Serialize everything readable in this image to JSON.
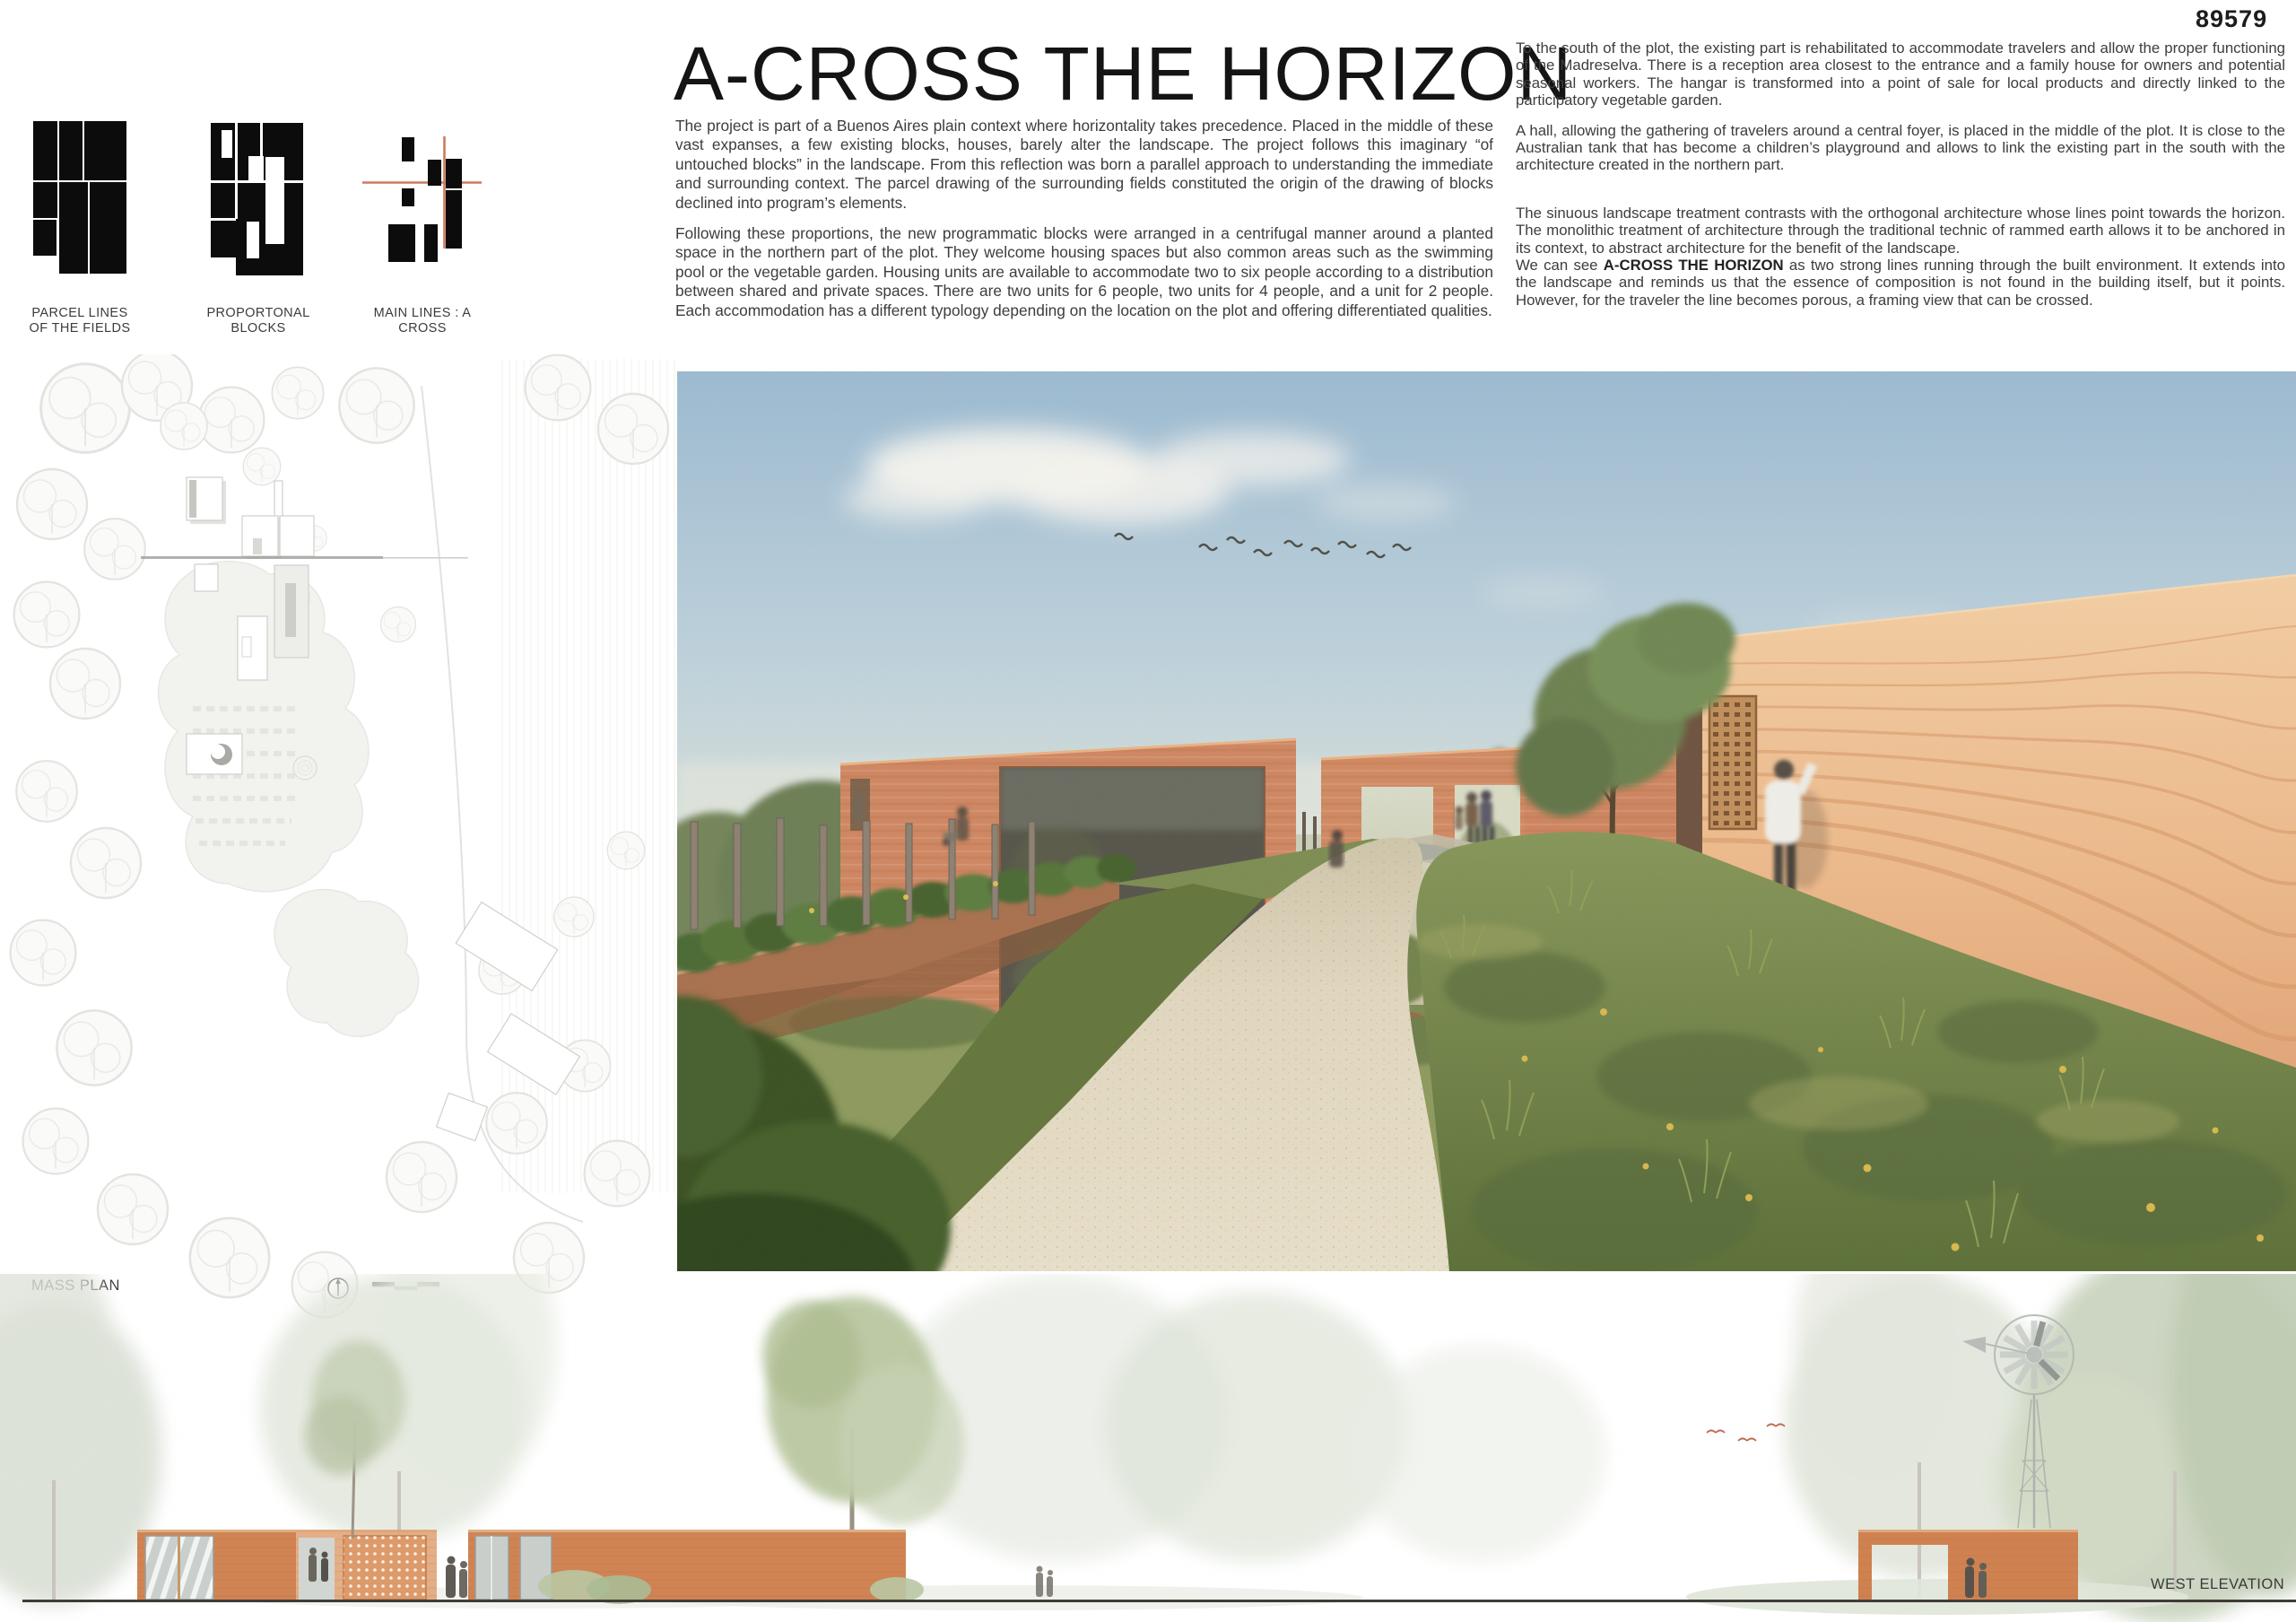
{
  "board": {
    "entry_number": "89579",
    "title": "A-CROSS THE HORIZON"
  },
  "concept_diagrams": {
    "parcel_label_line1": "PARCEL LINES",
    "parcel_label_line2": "OF THE FIELDS",
    "blocks_label": "PROPORTONAL BLOCKS",
    "lines_label": "MAIN LINES : A CROSS"
  },
  "intro": {
    "p1": "The project is part of a Buenos Aires plain context where horizontality takes precedence. Placed in the middle of these vast expanses, a few existing blocks, houses, barely alter the landscape. The project follows this imaginary “of untouched blocks” in the landscape. From this reflection was born a parallel approach to understanding the immediate and surrounding context. The parcel drawing of the surrounding fields constituted the origin of the drawing of blocks declined into program’s elements.",
    "p2": "Following these proportions, the new programmatic blocks were arranged in a centrifugal manner around a planted space in the northern part of the plot. They welcome housing spaces but also common areas such as the swimming pool or the vegetable garden. Housing units are available to accommodate two to six people according to a distribution between shared and private spaces. There are two units for 6 people, two units for 4 people, and a unit for 2 people. Each accommodation has a different typology depending on the location on the plot and offering differentiated qualities."
  },
  "description": {
    "p1": "To the south of the plot, the existing part is rehabilitated to accommodate travelers and allow the proper functioning of the Madreselva. There is a reception area closest to the entrance and a family house for owners and potential seasonal workers. The hangar is transformed into a point of sale for local products and directly linked to the participatory vegetable garden.",
    "p2": "A hall, allowing the gathering of travelers around a central foyer, is placed in the middle of the plot. It is close to the Australian tank that has become a children’s playground and allows to link the existing part in the south with the architecture created in the northern part.",
    "p3_before": "The sinuous landscape treatment contrasts with the orthogonal architecture whose lines point towards the horizon. The monolithic treatment of architecture through the traditional technic of rammed earth allows it to be anchored in its context, to abstract architecture for the benefit of the landscape.\nWe can see ",
    "p3_bold": "A-CROSS THE HORIZON",
    "p3_after": " as two strong lines running through the built environment. It extends into the landscape and reminds us that the essence of composition is not found in the building itself, but it points. However, for the traveler the line becomes porous, a framing view that can be crossed."
  },
  "mass_plan": {
    "label": "MASS PLAN"
  },
  "elevation": {
    "label": "WEST ELEVATION"
  },
  "colors": {
    "accent_terracotta": "#cc7a5c",
    "rammed_earth_wall": "#d28a63",
    "diagram_black": "#0c0c0c"
  }
}
